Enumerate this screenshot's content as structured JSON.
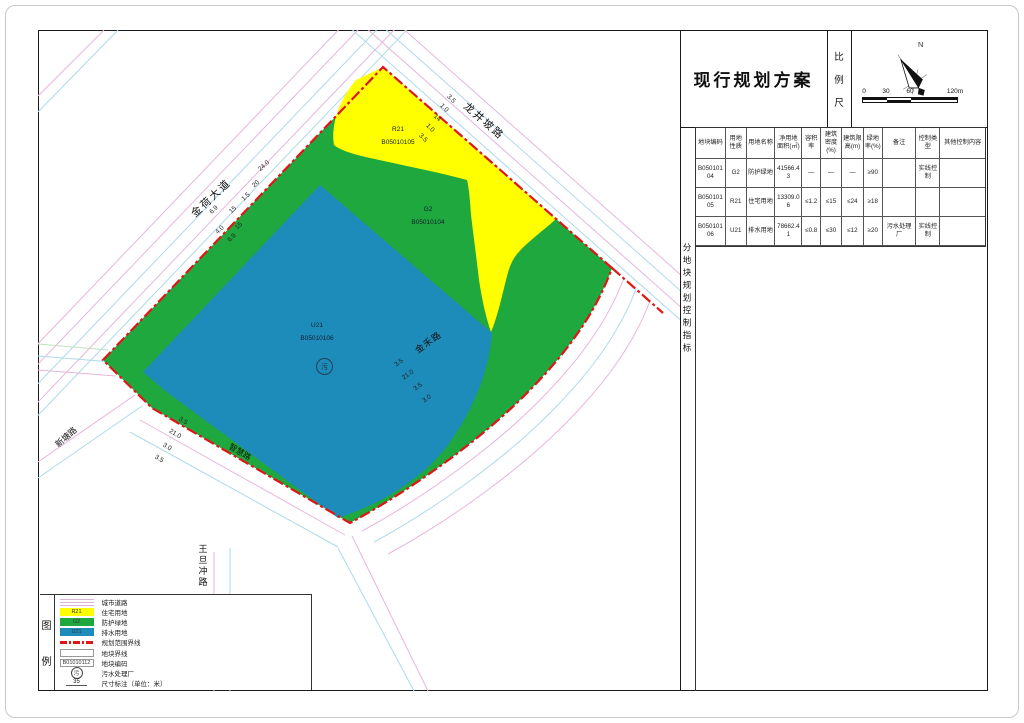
{
  "title_block": {
    "title": "现行规划方案",
    "scale_label": "比例尺",
    "north_label": "N",
    "scale_ticks": [
      "0",
      "30",
      "60",
      "120m"
    ]
  },
  "side_caption": "分地块规划控制指标",
  "table": {
    "headers": [
      "地块编码",
      "用地性质",
      "用地名称",
      "净用地面积(㎡)",
      "容积率",
      "建筑密度(%)",
      "建筑限高(m)",
      "绿地率(%)",
      "备注",
      "控制类型",
      "其他控制内容"
    ],
    "rows": [
      [
        "B05010104",
        "G2",
        "防护绿地",
        "41566.43",
        "—",
        "—",
        "—",
        "≥90",
        "",
        "实线控制",
        ""
      ],
      [
        "B05010105",
        "R21",
        "住宅用地",
        "13309.06",
        "≤1.2",
        "≤15",
        "≤24",
        "≥18",
        "",
        "",
        ""
      ],
      [
        "B05010106",
        "U21",
        "排水用地",
        "78662.41",
        "≤0.8",
        "≤30",
        "≤12",
        "≥20",
        "污水处理厂",
        "实线控制",
        ""
      ]
    ]
  },
  "legend": {
    "caption": "图例",
    "items": [
      {
        "label": "城市道路"
      },
      {
        "code": "R21",
        "label": "住宅用地"
      },
      {
        "code": "G2",
        "label": "防护绿地"
      },
      {
        "code": "U21",
        "label": "排水用地"
      },
      {
        "label": "规划范围界线"
      },
      {
        "label": "地块界线"
      },
      {
        "code": "B01010112",
        "label": "地块编码"
      },
      {
        "code": "污",
        "label": "污水处理厂"
      },
      {
        "code": "35",
        "label": "尺寸标注（单位：米）"
      }
    ]
  },
  "map": {
    "roads": [
      "金荷大道",
      "龙井坡路",
      "金禾路",
      "智慧路",
      "新塘路",
      "王旦冲路"
    ],
    "zones": [
      {
        "code": "R21",
        "block": "B05010105"
      },
      {
        "code": "G2",
        "block": "B05010104"
      },
      {
        "code": "U21",
        "block": "B05010106"
      }
    ],
    "plant_symbol": "污",
    "dimension_groups": [
      {
        "road": "金荷大道",
        "rotate": -43,
        "labels": [
          {
            "t": "24.0",
            "x": 264,
            "y": 166
          },
          {
            "t": "20",
            "x": 256,
            "y": 184
          },
          {
            "t": "1.5",
            "x": 246,
            "y": 197
          },
          {
            "t": "15",
            "x": 233,
            "y": 210
          },
          {
            "t": "6.9",
            "x": 214,
            "y": 210
          },
          {
            "t": "15",
            "x": 239,
            "y": 226
          },
          {
            "t": "4.0",
            "x": 220,
            "y": 230
          },
          {
            "t": "6.9",
            "x": 232,
            "y": 238
          }
        ]
      },
      {
        "road": "龙井坡路",
        "rotate": 45,
        "labels": [
          {
            "t": "3.5",
            "x": 451,
            "y": 99
          },
          {
            "t": "1.0",
            "x": 444,
            "y": 108
          },
          {
            "t": "14",
            "x": 437,
            "y": 118
          },
          {
            "t": "1.0",
            "x": 430,
            "y": 128
          },
          {
            "t": "3.5",
            "x": 423,
            "y": 138
          }
        ]
      },
      {
        "road": "金禾路",
        "rotate": -36,
        "labels": [
          {
            "t": "3.5",
            "x": 399,
            "y": 363
          },
          {
            "t": "21.0",
            "x": 408,
            "y": 375
          },
          {
            "t": "3.5",
            "x": 418,
            "y": 387
          },
          {
            "t": "3.0",
            "x": 427,
            "y": 399
          }
        ]
      },
      {
        "road": "智慧路",
        "rotate": 31,
        "labels": [
          {
            "t": "3.5",
            "x": 183,
            "y": 421
          },
          {
            "t": "21.0",
            "x": 175,
            "y": 434
          },
          {
            "t": "3.0",
            "x": 167,
            "y": 447
          },
          {
            "t": "3.5",
            "x": 159,
            "y": 459
          }
        ]
      }
    ]
  },
  "colors": {
    "residential_yellow": "#ffff00",
    "protective_green": "#1ea83e",
    "drainage_blue": "#1e8cba",
    "boundary_red": "#e01616",
    "road_pink": "#e7b6da",
    "road_cyan": "#aed9ea"
  }
}
